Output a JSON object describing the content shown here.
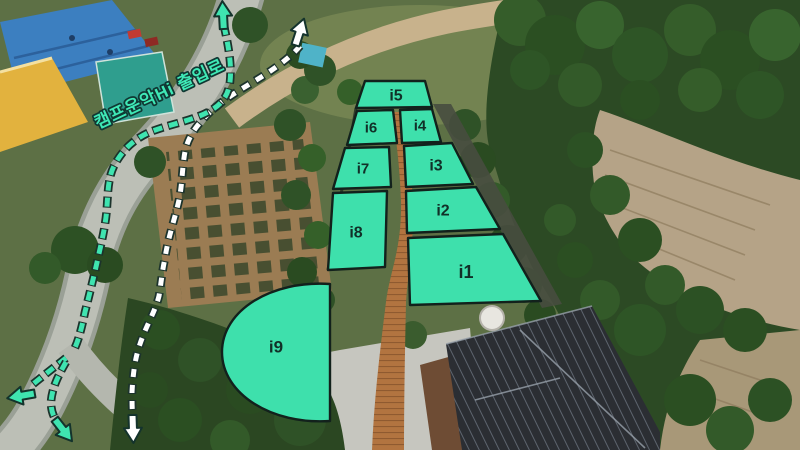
{
  "map": {
    "entrance_label": "캠프운악Hi 출입로",
    "zones": [
      {
        "id": "i1",
        "label": "i1"
      },
      {
        "id": "i2",
        "label": "i2"
      },
      {
        "id": "i3",
        "label": "i3"
      },
      {
        "id": "i4",
        "label": "i4"
      },
      {
        "id": "i5",
        "label": "i5"
      },
      {
        "id": "i6",
        "label": "i6"
      },
      {
        "id": "i7",
        "label": "i7"
      },
      {
        "id": "i8",
        "label": "i8"
      },
      {
        "id": "i9",
        "label": "i9"
      }
    ],
    "colors": {
      "zone_fill": "#3EE0AC",
      "zone_border": "#12211C",
      "zone_label": "#113028",
      "route_primary": "#3FE4B0",
      "route_secondary": "#FFFFFF",
      "entrance_text": "#3FE8B6"
    },
    "icons": {
      "green_up_arrow": "↑",
      "white_up_arrow": "↑",
      "green_left_arrow": "←",
      "green_down_right_arrow": "↘",
      "white_down_arrow": "↓"
    }
  }
}
